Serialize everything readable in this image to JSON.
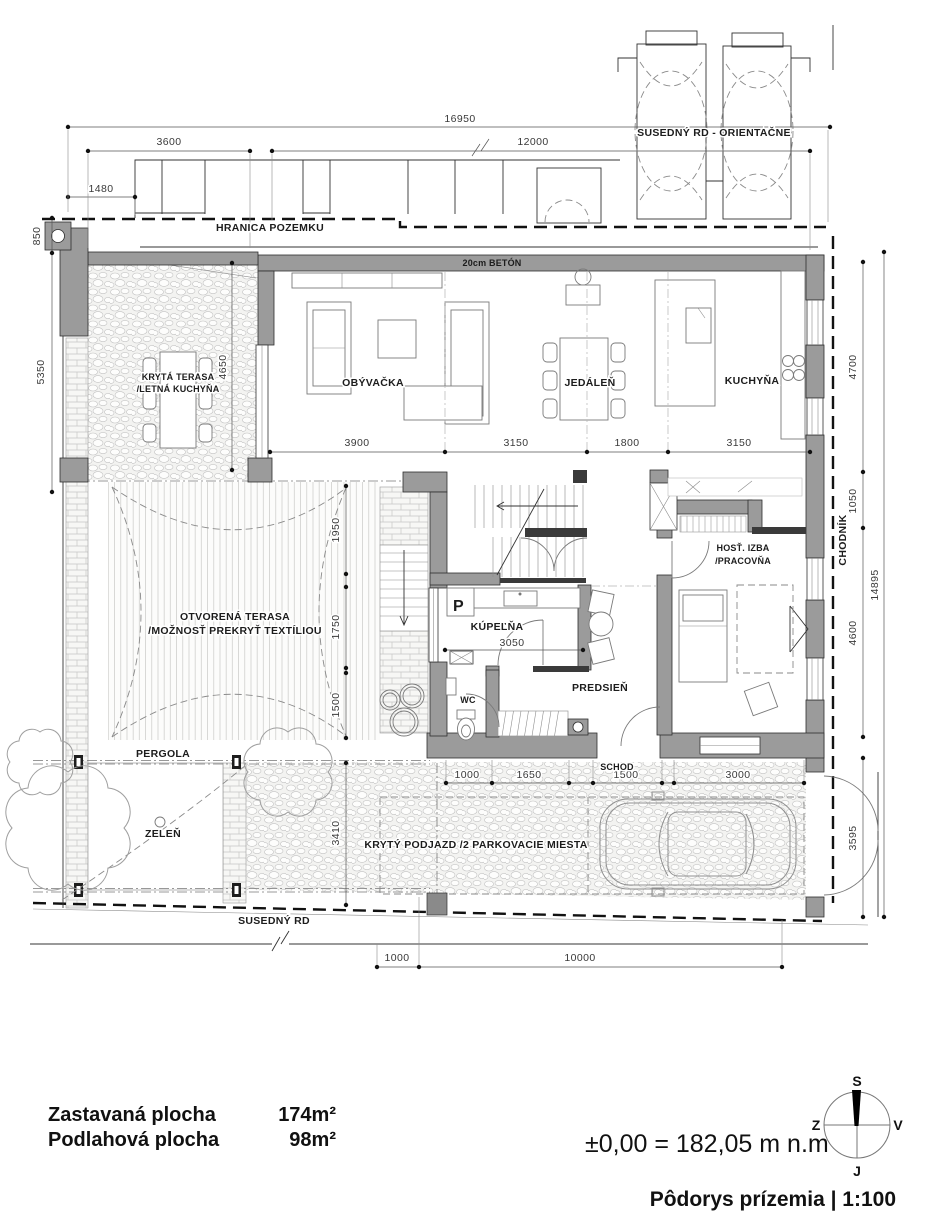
{
  "colors": {
    "wall": "#9b9b9b",
    "line": "#222222"
  },
  "plan": {
    "site": {
      "boundary_label": "HRANICA POZEMKU",
      "neighbor_top_label": "SUSEDNÝ RD - ORIENTAČNE",
      "neighbor_bottom_label": "SUSEDNÝ RD",
      "sidewalk_label": "CHODNÍK",
      "wall_note": "20cm BETÓN",
      "pergola_label": "PERGOLA",
      "greenery_label": "ZELEŇ",
      "driveway_label": "KRYTÝ PODJAZD /2 PARKOVACIE MIESTA",
      "exterior_stair_label": "SCHOD"
    },
    "rooms": {
      "living": "OBÝVAČKA",
      "dining": "JEDÁLEŇ",
      "kitchen": "KUCHYŇA",
      "covered_terrace_line1": "KRYTÁ TERASA",
      "covered_terrace_line2": "/LETNÁ KUCHYŇA",
      "open_terrace_line1": "OTVORENÁ TERASA",
      "open_terrace_line2": "/MOŽNOSŤ PREKRYŤ TEXTÍLIOU",
      "guest_line1": "HOSŤ. IZBA",
      "guest_line2": "/PRACOVŇA",
      "bathroom": "KÚPEĽŇA",
      "wc": "WC",
      "hallway": "PREDSIEŇ",
      "washer_mark": "P"
    },
    "dims": {
      "total_width": "16950",
      "left_wing": "3600",
      "house_width": "12000",
      "porch": "1480",
      "corner": "850",
      "terrace_height": "5350",
      "terrace_inner": "4650",
      "living": "3900",
      "dining": "3150",
      "island": "1800",
      "kitchen": "3150",
      "bath": "3050",
      "terrace_seg1": "1950",
      "terrace_seg2": "1750",
      "terrace_seg3": "1500",
      "pergola_height": "3410",
      "kitchen_side": "4700",
      "hall_side": "1050",
      "guest_side": "4600",
      "total_height": "14895",
      "gate": "3595",
      "entry1": "1000",
      "entry2": "1650",
      "entry3": "1500",
      "entry4": "3000",
      "bottom_offset": "1000",
      "bottom_width": "10000"
    }
  },
  "legend": {
    "built_area_label": "Zastavaná plocha",
    "built_area_value": "174m²",
    "floor_area_label": "Podlahová plocha",
    "floor_area_value": "98m²",
    "elevation_note": "±0,00 = 182,05 m n.m",
    "title": "Pôdorys prízemia | 1:100"
  },
  "compass": {
    "n": "S",
    "w": "Z",
    "e": "V",
    "s": "J"
  }
}
